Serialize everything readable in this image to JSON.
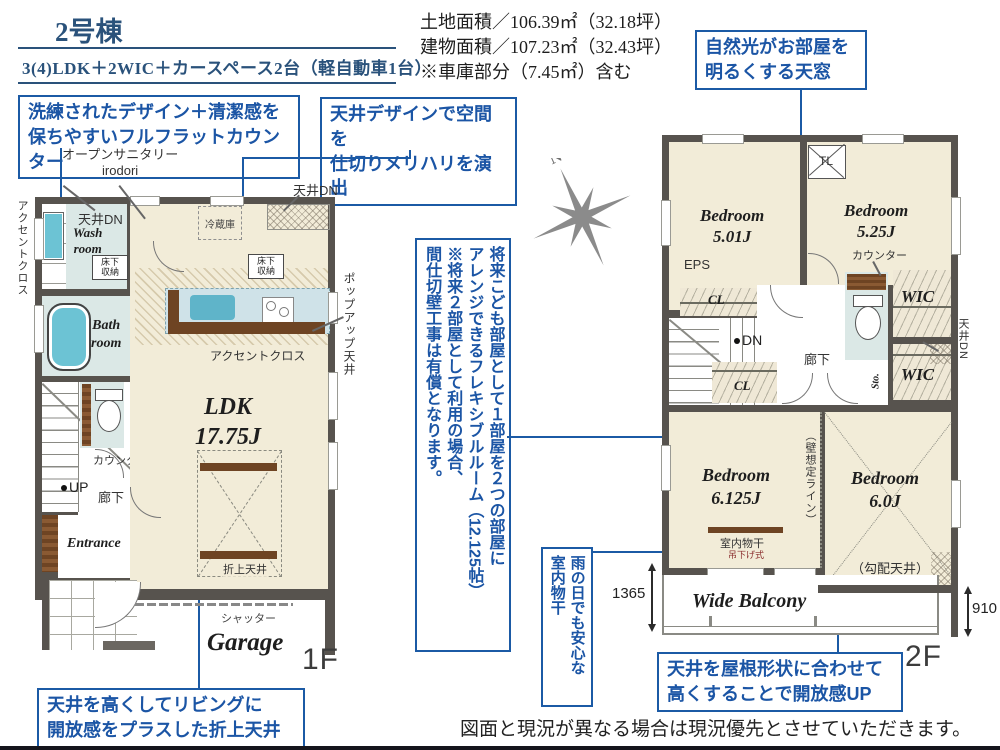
{
  "header": {
    "building_no": "2号棟",
    "plan_type": "3(4)LDK＋2WIC＋カースペース2台（軽自動車1台）",
    "land_area": "土地面積／106.39㎡（32.18坪）",
    "building_area": "建物面積／107.23㎡（32.43坪）",
    "note": "※車庫部分（7.45㎡）含む"
  },
  "callouts": {
    "flat_counter": "洗練されたデザイン＋清潔感を\n保ちやすいフルフラットカウンター",
    "ceiling_design": "天井デザインで空間を\n仕切りメリハリを演出",
    "skylight": "自然光がお部屋を\n明るくする天窓",
    "folded_ceiling": "天井を高くしてリビングに\n開放感をプラスした折上天井",
    "sloped_ceiling": "天井を屋根形状に合わせて\n高くすることで開放感UP",
    "flexible_room": "将来こども部屋として１部屋を２つの部屋に\nアレンジできるフレキシブルルーム（12.125帖）\n※将来２部屋として利用の場合、\n間仕切壁工事は有償となります。",
    "indoor_drying": "雨の日でも安心な\n室内物干"
  },
  "floor1": {
    "floor_label": "1F",
    "open_sanitary": "オープンサニタリー\nirodori",
    "accent_cross_side": "アクセントクロス",
    "ceiling_dn_wash": "天井DN",
    "wash_room": "Wash\nroom",
    "washer": "洗濯機",
    "underfloor_wash": "床下\n収納",
    "fridge": "冷蔵庫",
    "ceiling_dn_top": "天井DN",
    "underfloor_kitchen": "床下\n収納",
    "movable_shelf": "可動棚4段",
    "bath_room": "Bath\nroom",
    "sto": "Sto.",
    "ps": "PS",
    "accent_cross_kitchen": "アクセントクロス",
    "popup_ceiling": "ポップアップ天井",
    "counter": "カウンター",
    "up": "UP",
    "hallway": "廊下",
    "entrance": "Entrance",
    "ldk": "LDK\n17.75J",
    "folded_ceiling": "折上天井",
    "shutter": "シャッター",
    "garage": "Garage"
  },
  "floor2": {
    "floor_label": "2F",
    "bedroom1": "Bedroom\n5.01J",
    "skylight_tl": "TL",
    "bedroom2": "Bedroom\n5.25J",
    "eps": "EPS",
    "cl1": "CL",
    "dn": "DN",
    "cl2": "CL",
    "hallway": "廊下",
    "counter": "カウンター",
    "wic1": "WIC",
    "wic2": "WIC",
    "sto": "Sto.",
    "ceiling_dn": "天井DN",
    "wall_line": "（壁想定ライン）",
    "bedroom3": "Bedroom\n6.125J",
    "indoor_pole": "室内物干",
    "hanging_type": "吊下げ式",
    "bedroom4": "Bedroom\n6.0J",
    "sloped": "（勾配天井）",
    "balcony": "Wide Balcony",
    "dim_left": "1365",
    "dim_right": "910"
  },
  "compass": {
    "north": "N"
  },
  "footer": {
    "disclaimer": "図面と現況が異なる場合は現況優先とさせていただきます。"
  },
  "colors": {
    "accent_blue": "#1b5aa5",
    "header_navy": "#2a527b",
    "wall_gray": "#57534e",
    "room_beige": "#f2ecd8",
    "wet_blue": "#dbe8e6",
    "fixture_cyan": "#6cc3d4",
    "wood_brown": "#6e4423"
  }
}
